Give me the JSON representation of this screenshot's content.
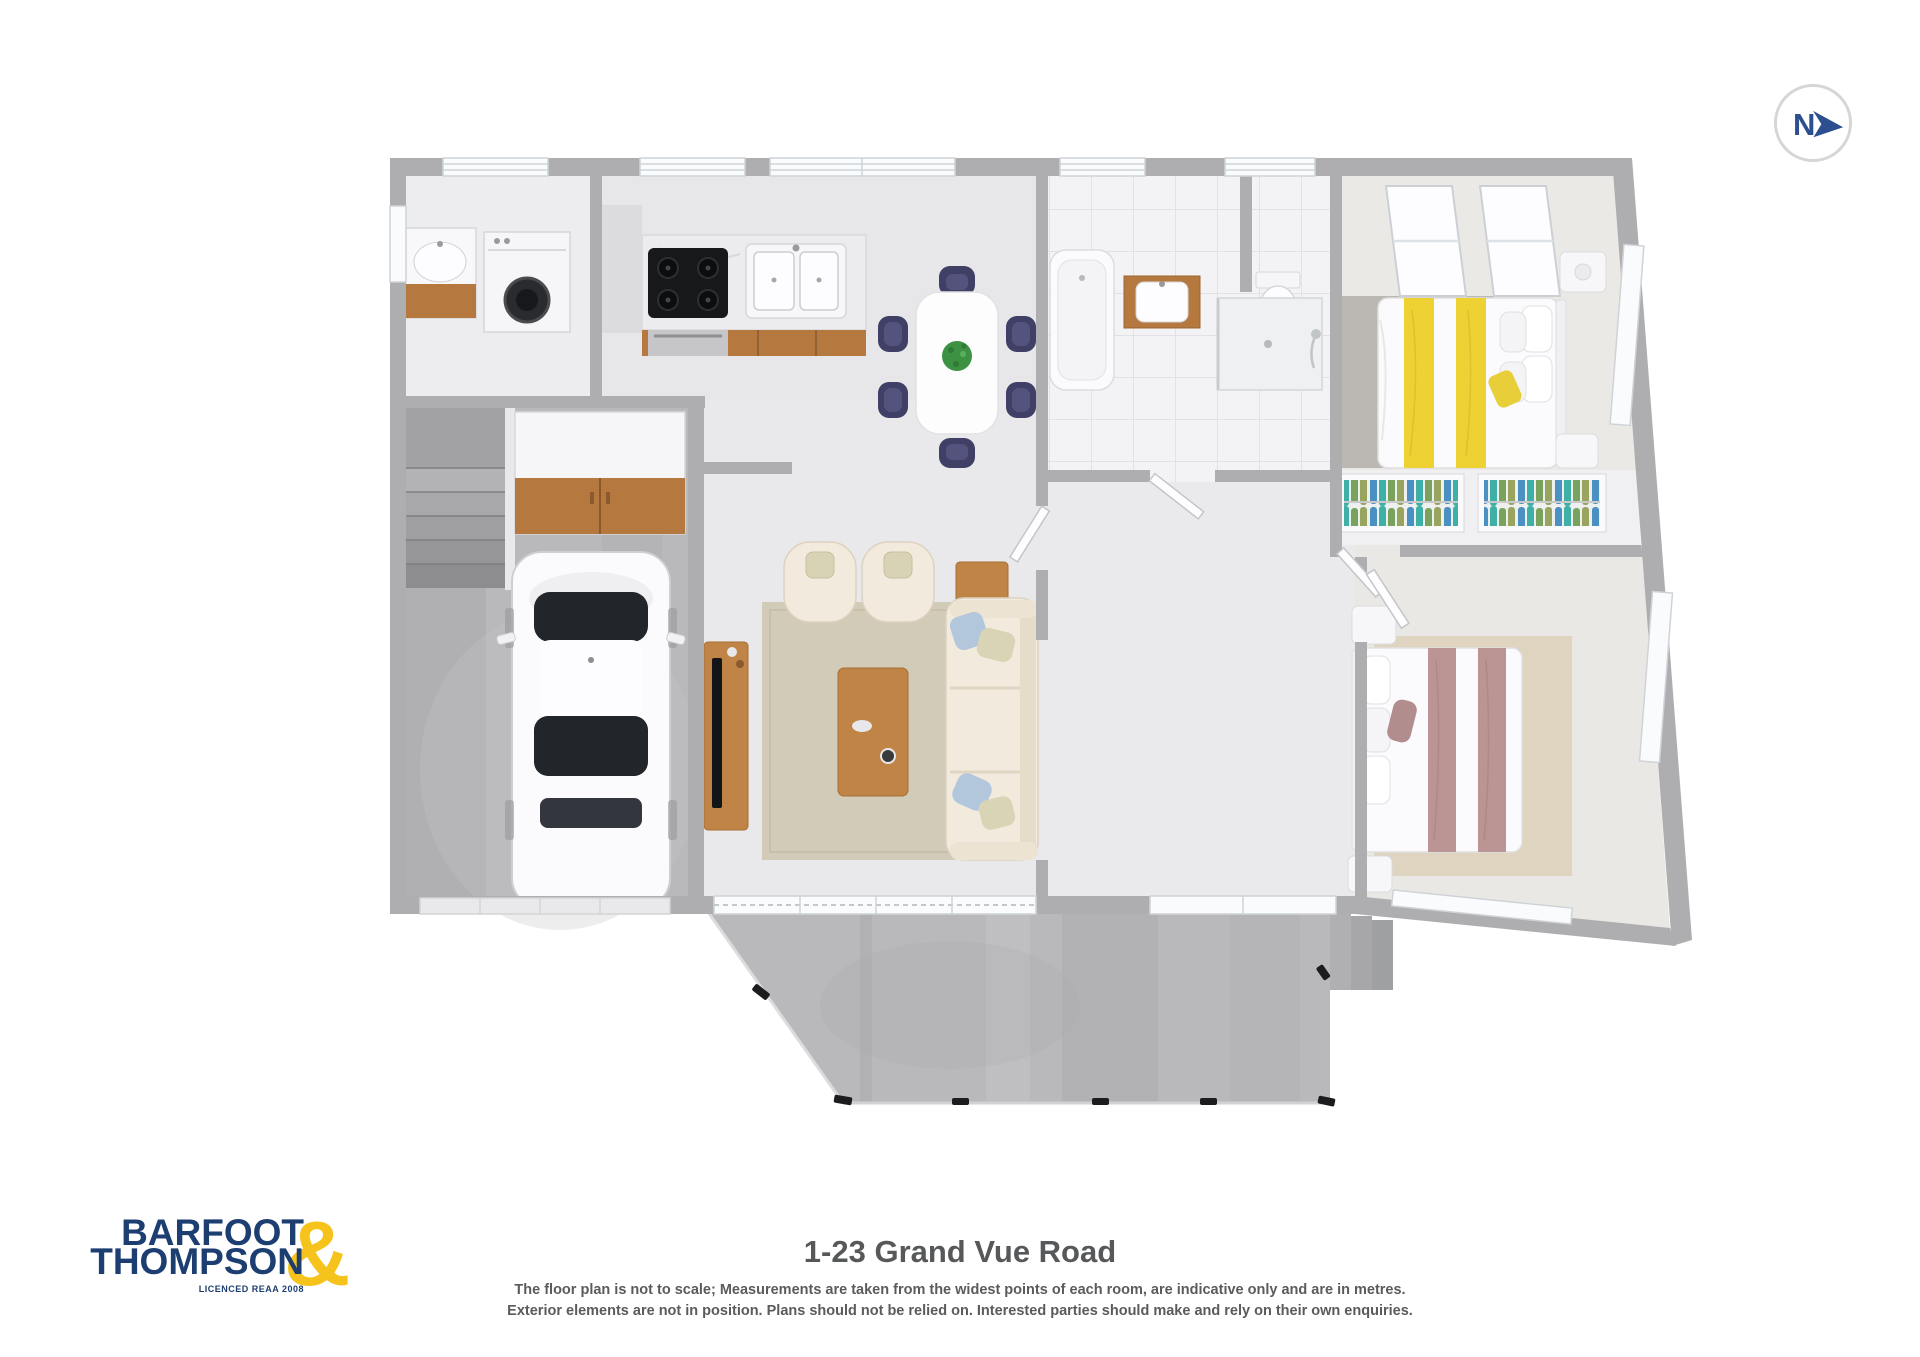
{
  "compass": {
    "label": "N"
  },
  "logo": {
    "word1": "BARFOOT",
    "word2": "THOMPSON",
    "ampersand": "&",
    "licence": "LICENCED REAA 2008"
  },
  "footer": {
    "title": "1-23 Grand Vue Road",
    "disclaimer1": "The floor plan is not to scale; Measurements are taken from the widest points of each room, are indicative only and are in metres.",
    "disclaimer2": "Exterior elements are not in position. Plans should not be relied on. Interested parties should make and rely on their own enquiries."
  },
  "colors": {
    "logo_navy": "#1c3e70",
    "logo_gold": "#f6c31c",
    "compass_navy": "#2d4e8f",
    "title_gray": "#57585a",
    "wall_gray": "#aeaeb0",
    "concrete": "#b9b9bb",
    "wood": "#c08447",
    "accent_yellow": "#eed234",
    "accent_mauve": "#bb9494",
    "chair_navy": "#403f66"
  }
}
